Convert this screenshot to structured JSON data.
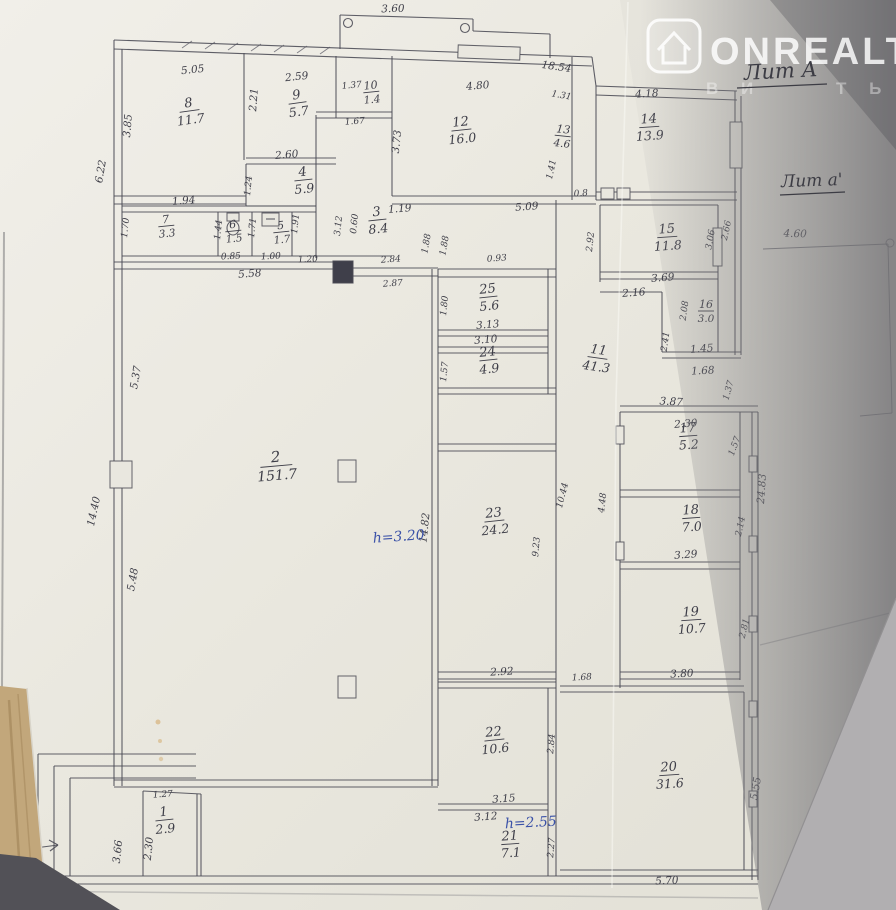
{
  "photo": {
    "watermark": {
      "brand": "ONREALT",
      "sub_left": "В И",
      "sub_right": "Т Ь"
    },
    "handwritten": {
      "lit_main": "Лит А",
      "lit_annex": "Лит а'",
      "height_main": "h=3.20",
      "height_annex": "h=2.55"
    }
  },
  "rooms": [
    {
      "n": "1",
      "a": "2.9"
    },
    {
      "n": "2",
      "a": "151.7"
    },
    {
      "n": "3",
      "a": "8.4"
    },
    {
      "n": "4",
      "a": "5.9"
    },
    {
      "n": "5",
      "a": "1.7"
    },
    {
      "n": "6",
      "a": "1.5"
    },
    {
      "n": "7",
      "a": "3.3"
    },
    {
      "n": "8",
      "a": "11.7"
    },
    {
      "n": "9",
      "a": "5.7"
    },
    {
      "n": "10",
      "a": "1.4"
    },
    {
      "n": "11",
      "a": "41.3"
    },
    {
      "n": "12",
      "a": "16.0"
    },
    {
      "n": "13",
      "a": "4.6"
    },
    {
      "n": "14",
      "a": "13.9"
    },
    {
      "n": "15",
      "a": "11.8"
    },
    {
      "n": "16",
      "a": "3.0"
    },
    {
      "n": "17",
      "a": "5.2"
    },
    {
      "n": "18",
      "a": "7.0"
    },
    {
      "n": "19",
      "a": "10.7"
    },
    {
      "n": "20",
      "a": "31.6"
    },
    {
      "n": "21",
      "a": "7.1"
    },
    {
      "n": "22",
      "a": "10.6"
    },
    {
      "n": "23",
      "a": "24.2"
    },
    {
      "n": "24",
      "a": "4.9"
    },
    {
      "n": "25",
      "a": "5.6"
    }
  ],
  "dims": [
    "3.60",
    "5.05",
    "2.59",
    "1.37",
    "1.67",
    "2.21",
    "3.85",
    "6.22",
    "4.80",
    "18.54",
    "1.31",
    "4.18",
    "3.73",
    "1.41",
    "2.60",
    "1.94",
    "1.70",
    "1.44",
    "1.71",
    "1.91",
    "3.12",
    "0.60",
    "1.19",
    "5.09",
    "1.88",
    "1.88",
    "0.85",
    "1.00",
    "5.58",
    "1.20",
    "2.84",
    "2.87",
    "0.93",
    "0.8",
    "2.66",
    "3.06",
    "3.69",
    "2.16",
    "2.08",
    "2.41",
    "1.45",
    "1.68",
    "4.60",
    "5.37",
    "14.40",
    "5.48",
    "1.80",
    "3.13",
    "3.10",
    "1.57",
    "3.87",
    "1.37",
    "2.30",
    "1.57",
    "4.48",
    "2.14",
    "24.83",
    "3.29",
    "9.23",
    "10.44",
    "14.82",
    "2.92",
    "1.68",
    "3.80",
    "2.81",
    "2.84",
    "3.15",
    "3.12",
    "2.27",
    "1.27",
    "2.30",
    "3.66",
    "5.70",
    "5.55",
    "1.24",
    "2.92"
  ]
}
